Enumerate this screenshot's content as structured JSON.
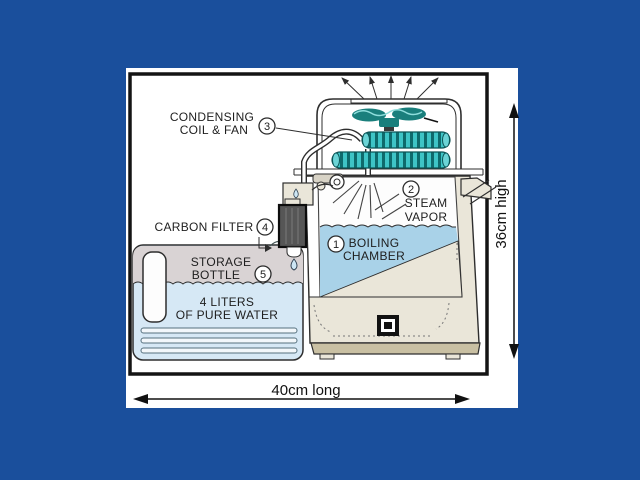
{
  "callouts": {
    "boiling_chamber": {
      "number": "1",
      "line1": "BOILING",
      "line2": "CHAMBER"
    },
    "steam_vapor": {
      "number": "2",
      "line1": "STEAM",
      "line2": "VAPOR"
    },
    "condensing": {
      "number": "3",
      "line1": "CONDENSING",
      "line2": "COIL & FAN"
    },
    "carbon_filter": {
      "number": "4",
      "text": "CARBON FILTER"
    },
    "storage_bottle": {
      "number": "5",
      "line1": "STORAGE",
      "line2": "BOTTLE"
    }
  },
  "annotations": {
    "volume_line1": "4 LITERS",
    "volume_line2": "OF PURE WATER"
  },
  "dimensions": {
    "height": "36cm high",
    "length": "40cm long"
  },
  "colors": {
    "background": "#1A4F9C",
    "panel": "#FFFFFF",
    "outline": "#2E2E2E",
    "chamber_water": "#A9D2E8",
    "bottle_water": "#D6E8F5",
    "bottle_top": "#D9D3D4",
    "machine_body": "#EAE6D9",
    "machine_base": "#C9C0A3",
    "coil": "#3EC4C6",
    "coil_dark": "#0E6A6C",
    "fan": "#1A7F7C",
    "filter": "#565656",
    "droplet": "#CDE6F4"
  }
}
